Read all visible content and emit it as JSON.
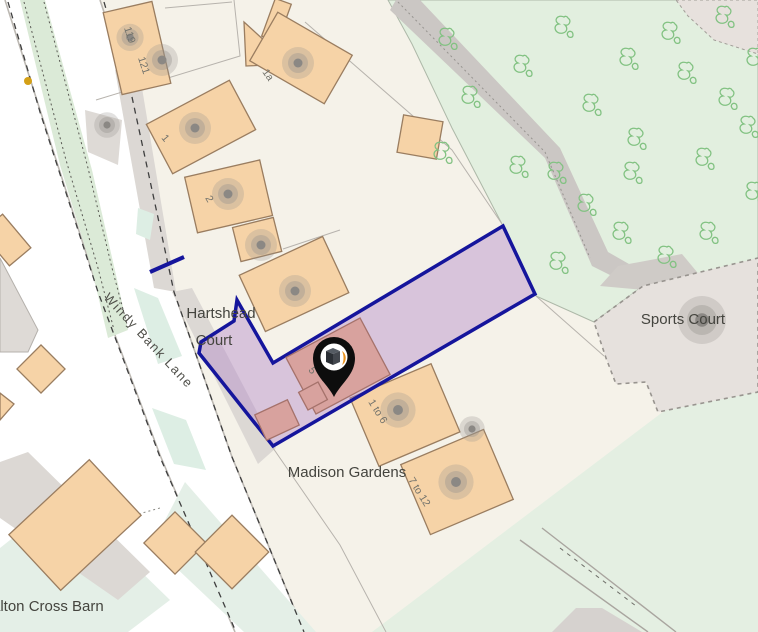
{
  "map": {
    "title": "Property location map",
    "labels": {
      "hartshead_line1": "Hartshead",
      "hartshead_line2": "Court",
      "road_name": "Windy Bank Lane",
      "madison_gardens": "Madison Gardens",
      "sports_court": "Sports Court",
      "barn": "alton Cross Barn",
      "n119": "119",
      "n121": "121",
      "n1a": "1a",
      "n1": "1",
      "n2": "2",
      "n5": "5",
      "n1to6": "1 to 6",
      "n7to12": "7 to 12"
    },
    "icons": {
      "marker": "black map pin with house-cube and orange leaf logo",
      "tree": "deciduous tree outline symbol",
      "blob": "gray house location blob"
    },
    "colors": {
      "background": "#f5f2e9",
      "plot_white": "#ffffff",
      "building_fill": "#f6d3a7",
      "building_border": "#9a7d60",
      "parcel_fill": "#b185c7",
      "parcel_border": "#15159c",
      "highlight_building": "#d8a29e",
      "highlight_border": "#a5726b",
      "green_area": "#e2efdf",
      "grass": "#e4efe2",
      "tree_stroke": "#82c282",
      "court_fill": "#e6e1dd",
      "road_casing": "#bcb8b2",
      "gray_area": "#dcd8d4",
      "marker_black": "#0d0d0d",
      "marker_orange": "#e8921e",
      "yellow_dot": "#d4a017"
    }
  }
}
